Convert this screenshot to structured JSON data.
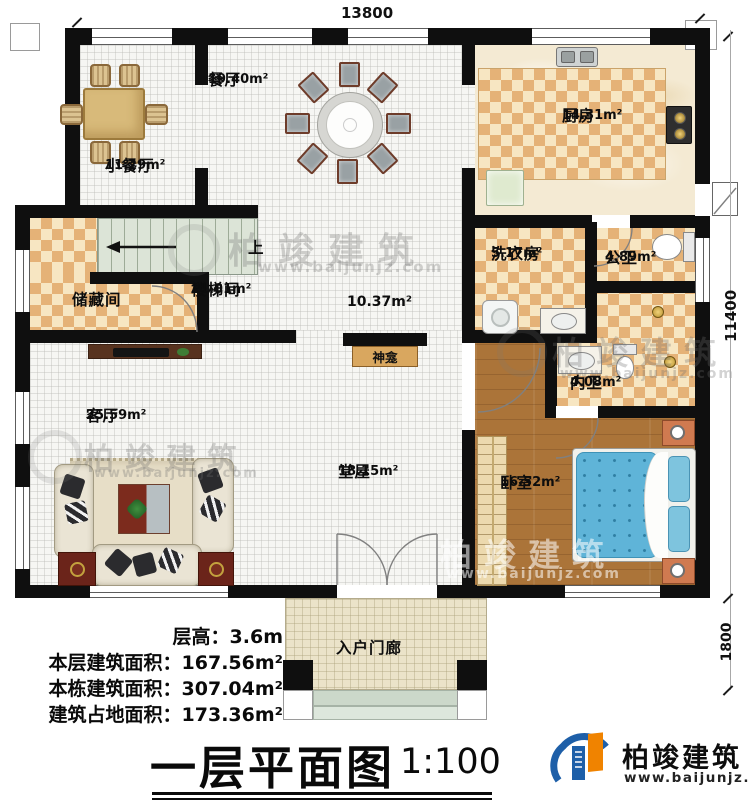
{
  "dimensions": {
    "width_top": "13800",
    "height_right": "11400",
    "porch_depth": "1800"
  },
  "rooms": {
    "small_dining": {
      "name": "小餐厅",
      "area": "11.29m²"
    },
    "dining": {
      "name": "餐厅",
      "area": "19.40m²"
    },
    "kitchen": {
      "name": "厨房",
      "area": "14.31m²"
    },
    "storage": {
      "name": "储藏间"
    },
    "stairwell": {
      "name": "楼梯间",
      "area": "11.01m²"
    },
    "hallway": {
      "area": "10.37m²"
    },
    "laundry": {
      "name": "洗衣房",
      "area": "5.17m²"
    },
    "public_bath": {
      "name": "公卫",
      "area": "4.89m²"
    },
    "private_bath": {
      "name": "内卫",
      "area": "4.08m²"
    },
    "living": {
      "name": "客厅",
      "area": "25.59m²"
    },
    "hall": {
      "name": "堂屋",
      "area": "18.15m²"
    },
    "bedroom": {
      "name": "卧室",
      "area": "16.52m²"
    },
    "porch": {
      "name": "入户门廊"
    },
    "shrine": {
      "name": "神龛"
    },
    "stairs_up": "上"
  },
  "info": {
    "floor_height": {
      "label": "层高：",
      "value": "3.6m"
    },
    "floor_area": {
      "label": "本层建筑面积：",
      "value": "167.56m²"
    },
    "building_area": {
      "label": "本栋建筑面积：",
      "value": "307.04m²"
    },
    "footprint_area": {
      "label": "建筑占地面积：",
      "value": "173.36m²"
    }
  },
  "title": {
    "text": "一层平面图",
    "scale": "1:100"
  },
  "brand": {
    "name": "柏竣建筑",
    "website": "www.baijunjz.com"
  },
  "watermark": {
    "text": "柏竣建筑",
    "website": "www.baijunjz.com"
  }
}
